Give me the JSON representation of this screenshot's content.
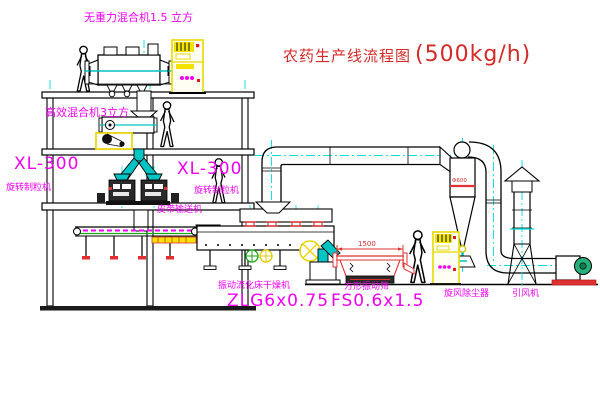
{
  "title": {
    "name": "农药生产线流程图",
    "capacity": "(500kg/h)"
  },
  "labels": {
    "gravity_free_mixer": "无重力混合机1.5 立方",
    "second_mixer": "高效混合机3立方",
    "granulator_left_model": "XL-300",
    "granulator_left_name": "旋转制粒机",
    "granulator_center_model": "XL-300",
    "granulator_center_name": "旋转制粒机",
    "belt_conveyor": "皮带输送机",
    "dryer_name": "振动流化床干燥机",
    "dryer_model": "ZLG6x0.75",
    "sieve_name": "方形振动筛",
    "sieve_model": "FS0.6x1.5",
    "cyclone": "旋风除尘器",
    "fan": "引风机"
  },
  "dimensions": {
    "sieve_length": "1500",
    "cyclone_diameter": "Φ600"
  },
  "colors": {
    "label_magenta": "#f000f0",
    "title_red": "#d42a2a",
    "centerline_cyan": "#00dede",
    "cabinet_yellow": "#f2e400",
    "chute_teal": "#00c4c4",
    "accent_red": "#e03030",
    "machine_green": "#28b07a",
    "line_black": "#000000",
    "background": "#ffffff"
  }
}
